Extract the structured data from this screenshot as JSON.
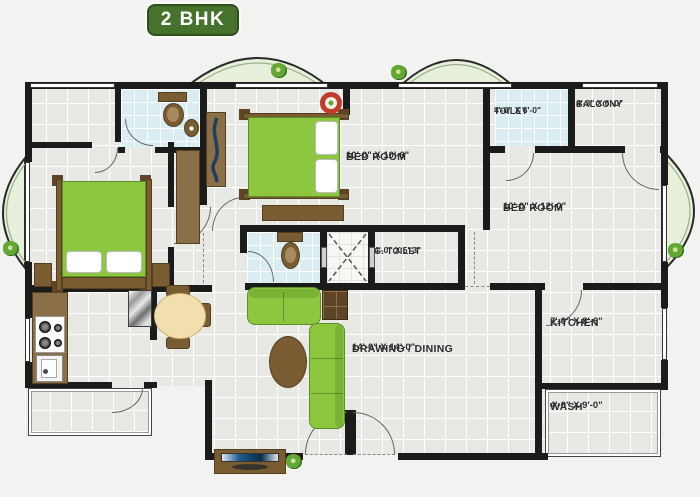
{
  "title": "2 BHK",
  "plan": {
    "rooms": [
      {
        "name": "BED ROOM",
        "dims": "10'-0\" X 10'-6\""
      },
      {
        "name": "TOILET",
        "dims": "4'-0\" X 6'-0\""
      },
      {
        "name": "BALCONY",
        "dims": "4'-3\" X 6'-0\""
      },
      {
        "name": "BED ROOM",
        "dims": "10'-0\" X 12'-0\""
      },
      {
        "name": "G. TOILET",
        "dims": "4'-0\" X 5'-3\""
      },
      {
        "name": "DRAWING / DINING",
        "dims": "14'-0\" X 14'-0\""
      },
      {
        "name": "KITCHEN",
        "dims": "7'-0\" X 8'-6\""
      },
      {
        "name": "WASH",
        "dims": "4'-0\" X 9'-0\""
      }
    ],
    "colors": {
      "wall": "#1b1b1b",
      "floor_tile": "#e8e8e5",
      "toilet_tile": "#d9edf3",
      "balcony_green": "#e6f0da",
      "furniture_green": "#8dc63f",
      "wood_brown": "#7a5c33",
      "badge_green": "#47722e",
      "fan_red": "#c23b2e"
    }
  }
}
